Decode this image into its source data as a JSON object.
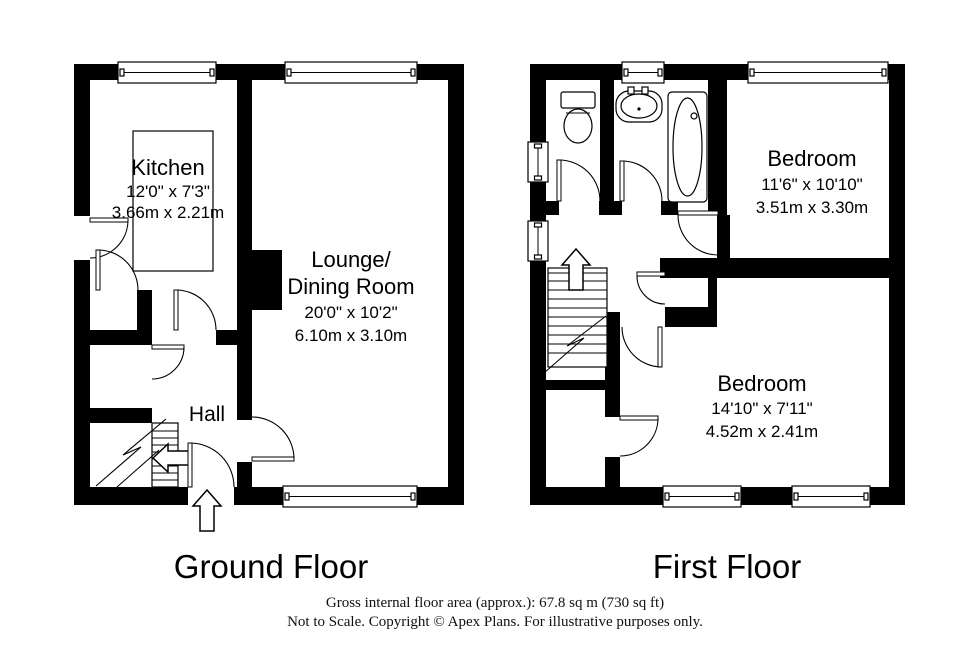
{
  "document": {
    "background_color": "#ffffff",
    "wall_color": "#000000",
    "text_color": "#000000"
  },
  "ground_floor": {
    "title": "Ground Floor",
    "kitchen_name": "Kitchen",
    "kitchen_dims_imperial": "12'0\" x 7'3\"",
    "kitchen_dims_metric": "3.66m x 2.21m",
    "lounge_name_line1": "Lounge/",
    "lounge_name_line2": "Dining Room",
    "lounge_dims_imperial": "20'0\" x 10'2\"",
    "lounge_dims_metric": "6.10m x 3.10m",
    "hall_name": "Hall"
  },
  "first_floor": {
    "title": "First Floor",
    "bedroom1_name": "Bedroom",
    "bedroom1_dims_imperial": "11'6\" x 10'10\"",
    "bedroom1_dims_metric": "3.51m x 3.30m",
    "bedroom2_name": "Bedroom",
    "bedroom2_dims_imperial": "14'10\" x 7'11\"",
    "bedroom2_dims_metric": "4.52m x 2.41m"
  },
  "footer": {
    "line1": "Gross internal floor area (approx.): 67.8 sq m (730 sq ft)",
    "line2": "Not to Scale. Copyright © Apex Plans. For illustrative purposes only."
  },
  "icons": {
    "entrance_arrow": "up-arrow",
    "stairs_arrow_ground": "left-arrow",
    "stairs_arrow_first": "up-arrow"
  }
}
